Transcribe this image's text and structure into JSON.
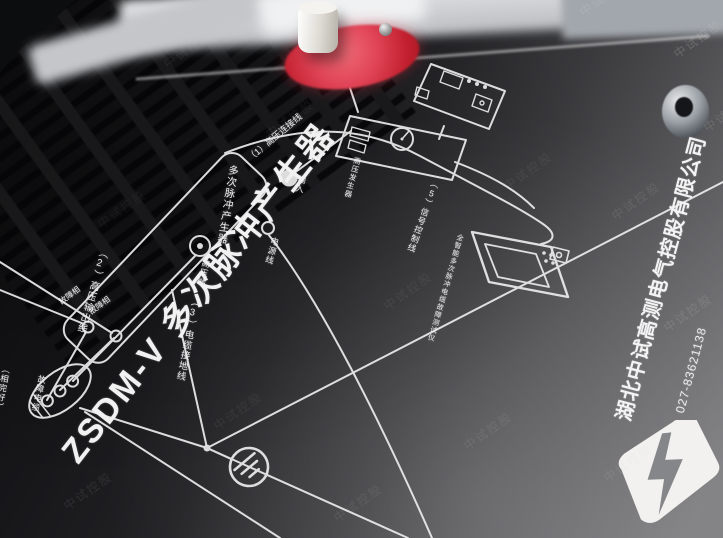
{
  "device": {
    "title": "ZSDM-V 多次脉冲产生器"
  },
  "diagram": {
    "producer_label": "多次脉冲产生器",
    "hv_source_label": "高压发生器",
    "tester_label": "全智能多次脉冲电缆故障测试仪",
    "terminals": {
      "hv": "高压端",
      "input": "输入",
      "power": "电源线"
    },
    "connections": {
      "c1": "（1）高压连接线",
      "c2": "（2）高压输出线",
      "c3": "（3）电缆接地线",
      "c5": "（5）信号控制线"
    },
    "cable": {
      "faulty_phase": "故障相",
      "intact_note": "（相完好）",
      "label": "故障电缆"
    }
  },
  "branding": {
    "company": "湖北中试高测电气控股有限公司",
    "tel": "TEL：027-83621138",
    "watermark": "中试控股"
  },
  "colors": {
    "panel_dark": "#0e0e10",
    "panel_light": "#7d7d80",
    "print_white": "#ececee",
    "hv_pad_red": "#d8293c",
    "knob_white": "#efede9",
    "logo_white": "#f2f1ef"
  }
}
